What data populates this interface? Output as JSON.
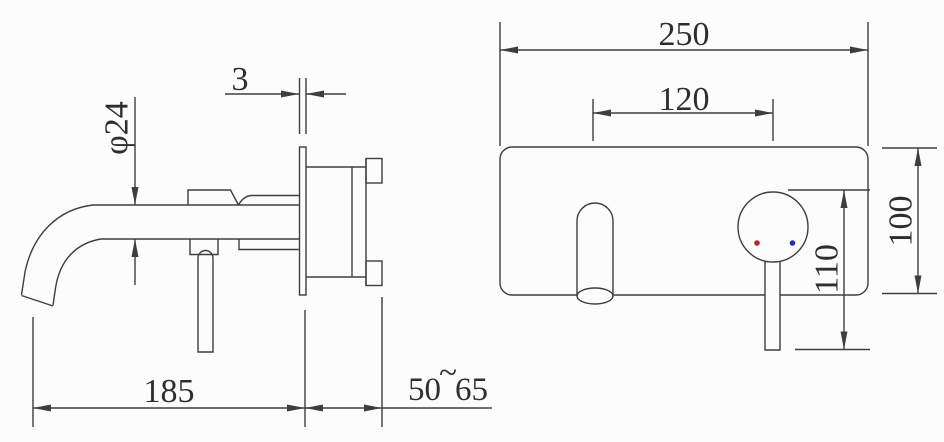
{
  "drawing": {
    "type": "technical installation drawing",
    "subject": "wall-mounted basin mixer tap — side view and front view",
    "background_color": "#fcfcfc",
    "line_color": "#3e3e3e",
    "views": {
      "side": {
        "dims": {
          "spout_diameter": "φ24",
          "plate_thickness": "3",
          "spout_reach": "185",
          "wall_depth_min": "50",
          "wall_depth_tilde": "~",
          "wall_depth_max": "65"
        }
      },
      "front": {
        "dims": {
          "plate_width": "250",
          "hole_spacing": "120",
          "handle_drop": "110",
          "plate_height": "100"
        },
        "hot_indicator_color": "#b3272f",
        "cold_indicator_color": "#2b2bb5"
      }
    }
  }
}
